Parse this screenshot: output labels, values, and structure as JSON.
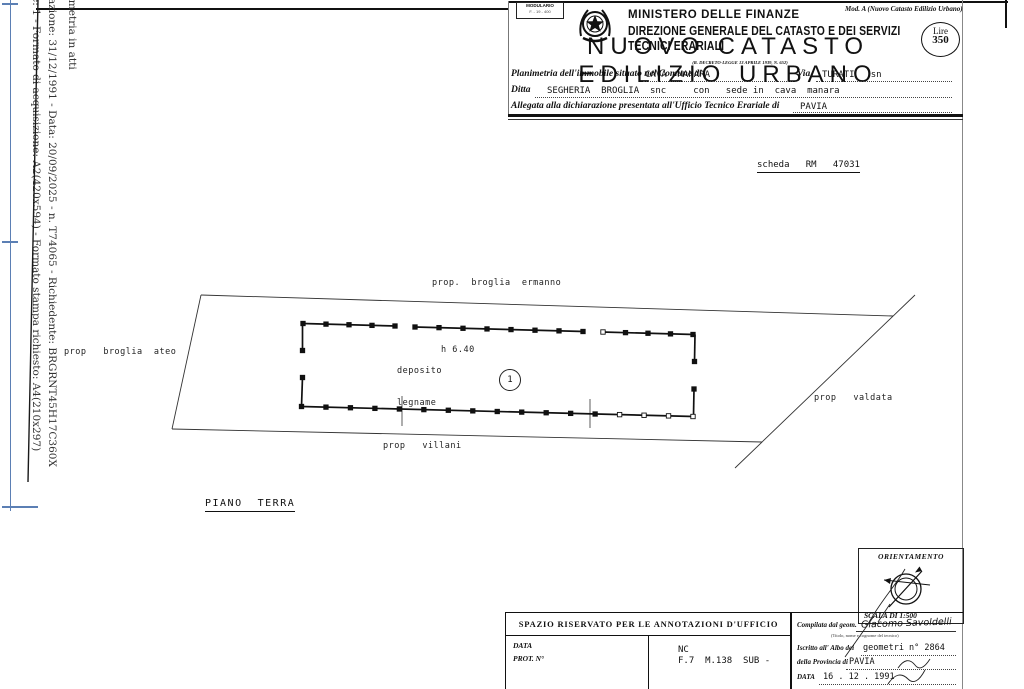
{
  "margin": {
    "fold_color": "#5b7fb4",
    "rotated_lines": [
      {
        "text": "Planimetria in atti"
      },
      {
        "text": "azione: 31/12/1991 - Data: 20/09/2025 - n. T74065 - Richiedente: BRGRNT45H17C360X"
      },
      {
        "text": "e: 1 - Formato di acquisizione: A2(420x594) - Formato stampa richiesto: A4(210x297)"
      }
    ]
  },
  "header": {
    "modulario_line1": "MODULARIO",
    "modulario_line2": "F. - 19 - 400",
    "mod_a": "Mod. A (Nuovo Catasto Edilizio Urbano)",
    "ministry": "MINISTERO DELLE FINANZE",
    "direction": "DIREZIONE GENERALE DEL CATASTO E DEI SERVIZI TECNICI ERARIALI",
    "title": "NUOVO CATASTO EDILIZIO URBANO",
    "decree": "(R. DECRETO-LEGGE 13 APRILE 1939, N. 652)",
    "stamp_line1": "Lire",
    "stamp_line2": "350"
  },
  "form": {
    "line1_label": "Planimetria dell'immobile situato nel Comune di",
    "line1_value": "CAVA  MANARA",
    "line1_label2": "Via",
    "line1_value2": "TURATI   sn",
    "line2_label": "Ditta",
    "line2_value": "SEGHERIA  BROGLIA  snc     con   sede in  cava  manara",
    "line3_label": "Allegata alla dichiarazione presentata all'Ufficio Tecnico Erariale di",
    "line3_value": "PAVIA"
  },
  "scheda": "scheda   RM   47031",
  "plan": {
    "label_top": "prop.  broglia  ermanno",
    "label_left": "prop   broglia  ateo",
    "label_bottom": "prop   villani",
    "label_right": "prop   valdata",
    "deposito_line1": "deposito",
    "deposito_line2": "legname",
    "height": "h 6.40",
    "unit_number": "1",
    "floor_label": "PIANO  TERRA"
  },
  "orientation": {
    "title": "ORIENTAMENTO",
    "scale": "SCALA DI 1:500"
  },
  "annotations": {
    "title": "SPAZIO RISERVATO PER LE ANNOTAZIONI D'UFFICIO",
    "data_label": "DATA",
    "prot_label": "PROT. N°",
    "ref_line1": "NC",
    "ref_line2": "F.7  M.138  SUB -"
  },
  "compiler": {
    "label1": "Compilata dal geom.",
    "name": "Giacomo Savoldelli",
    "subnote": "(Titolo, nome e cognome del tecnico)",
    "label2": "Iscritto all' Albo dei",
    "value2": "geometri n° 2864",
    "label3": "della Provincia di",
    "value3": "PAVIA",
    "date_label": "DATA",
    "date_value": "16 . 12 . 1991"
  }
}
